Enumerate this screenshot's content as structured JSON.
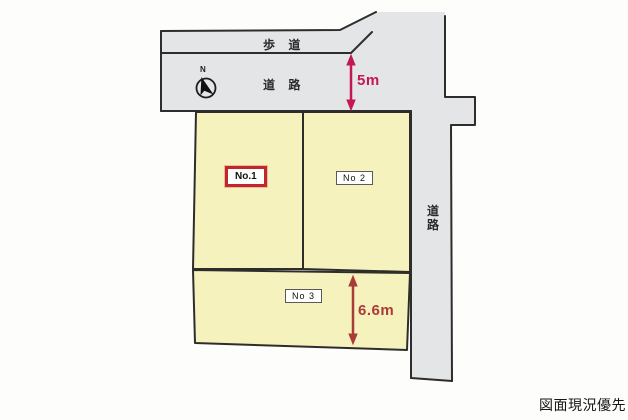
{
  "colors": {
    "road_gray": "#e4e5e7",
    "plot_yellow": "#f6f2bd",
    "outline": "#2e2d2b",
    "no1_border": "#c0262b",
    "dim_top_red": "#c21950",
    "dim_bottom_red": "#a93b38",
    "text_black": "#1d1d1f"
  },
  "roads": {
    "sidewalk_label": "歩 道",
    "front_road_label": "道 路",
    "side_road_label": "道路"
  },
  "compass": {
    "north_label": "N"
  },
  "dimensions": {
    "front_road_width": "5m",
    "plot3_depth": "6.6m"
  },
  "plots": [
    {
      "label": "No.1",
      "highlighted": true
    },
    {
      "label": "No 2",
      "highlighted": false
    },
    {
      "label": "No 3",
      "highlighted": false
    }
  ],
  "footer": {
    "note": "図面現況優先"
  }
}
